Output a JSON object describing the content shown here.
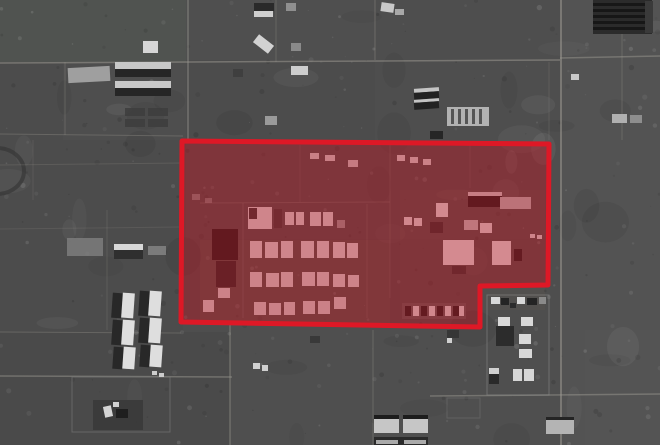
{
  "scene": {
    "description": "Grayscale satellite photograph of a desert compound with roads, warehouses, barracks rows and outlying villages; a large red polygon annotation highlights the central facility.",
    "width": 660,
    "height": 445,
    "ground_color": "#4e4e4e",
    "speckle_seed": 7,
    "patches": [
      [
        0,
        0,
        186,
        62,
        "#555a54",
        0.45
      ],
      [
        186,
        0,
        189,
        60,
        "#535353",
        0.4
      ],
      [
        560,
        0,
        100,
        445,
        "#5d5d5d",
        0.4
      ],
      [
        0,
        62,
        63,
        78,
        "#4a4a4a",
        0.3
      ],
      [
        186,
        60,
        189,
        83,
        "#4a4a4a",
        0.35
      ],
      [
        375,
        62,
        186,
        80,
        "#4f4f4f",
        0.3
      ],
      [
        0,
        140,
        183,
        192,
        "#4b4b4b",
        0.45
      ],
      [
        0,
        332,
        230,
        113,
        "#474747",
        0.4
      ],
      [
        230,
        330,
        330,
        115,
        "#525252",
        0.3
      ],
      [
        585,
        330,
        75,
        115,
        "#555555",
        0.3
      ],
      [
        186,
        143,
        363,
        96,
        "#565656",
        0.3
      ],
      [
        200,
        240,
        190,
        85,
        "#5e5a52",
        0.45
      ],
      [
        400,
        190,
        145,
        120,
        "#5a564f",
        0.4
      ]
    ],
    "roads": [
      [
        0,
        63,
        560,
        60,
        0.55,
        1.5
      ],
      [
        560,
        58,
        660,
        56,
        0.5,
        1.5
      ],
      [
        188,
        0,
        188,
        141,
        0.5,
        1.5
      ],
      [
        276,
        0,
        276,
        62,
        0.3,
        1
      ],
      [
        375,
        0,
        375,
        60,
        0.4,
        1
      ],
      [
        561,
        0,
        561,
        445,
        0.55,
        2
      ],
      [
        622,
        32,
        622,
        140,
        0.3,
        1
      ],
      [
        65,
        62,
        65,
        135,
        0.3,
        1
      ],
      [
        0,
        134,
        183,
        136,
        0.35,
        1
      ],
      [
        549,
        62,
        549,
        140,
        0.2,
        1
      ],
      [
        230,
        322,
        230,
        445,
        0.45,
        1.5
      ],
      [
        0,
        376,
        232,
        377,
        0.5,
        1.5
      ],
      [
        430,
        396,
        660,
        394,
        0.5,
        1.5
      ],
      [
        0,
        332,
        181,
        333,
        0.35,
        1
      ],
      [
        373,
        330,
        373,
        445,
        0.35,
        1
      ],
      [
        0,
        165,
        182,
        163,
        0.22,
        1
      ],
      [
        107,
        210,
        107,
        330,
        0.22,
        1
      ],
      [
        0,
        229,
        180,
        227,
        0.18,
        1
      ],
      [
        33,
        140,
        33,
        200,
        0.18,
        1
      ],
      [
        200,
        203,
        390,
        202,
        0.3,
        1
      ],
      [
        243,
        203,
        243,
        318,
        0.28,
        1
      ],
      [
        367,
        204,
        367,
        318,
        0.22,
        1
      ],
      [
        390,
        145,
        390,
        298,
        0.22,
        1
      ],
      [
        300,
        145,
        300,
        202,
        0.18,
        1
      ],
      [
        470,
        145,
        470,
        188,
        0.18,
        1
      ]
    ],
    "fences": [
      [
        72,
        377,
        98,
        55,
        "#7c7c7c",
        0.6
      ],
      [
        487,
        295,
        62,
        100,
        "#8a8a8a",
        0.55
      ],
      [
        447,
        398,
        33,
        20,
        "#7a7a7a",
        0.4
      ]
    ],
    "circle_feature": {
      "cx": -3,
      "cy": 171,
      "rx": 27,
      "ry": 23,
      "stroke": "#343434",
      "width": 4,
      "opacity": 0.6
    },
    "buildings": [
      [
        68,
        67,
        42,
        15,
        "#9f9f9f",
        1,
        -3
      ],
      [
        115,
        62,
        56,
        7,
        "#c8c8c8"
      ],
      [
        115,
        69,
        56,
        8,
        "#262626"
      ],
      [
        115,
        81,
        56,
        7,
        "#c8c8c8"
      ],
      [
        115,
        88,
        56,
        8,
        "#262626"
      ],
      [
        143,
        41,
        15,
        12,
        "#d6d6d6"
      ],
      [
        125,
        108,
        20,
        8,
        "#3c3c3c",
        0.8
      ],
      [
        148,
        108,
        20,
        8,
        "#3c3c3c",
        0.8
      ],
      [
        125,
        119,
        20,
        8,
        "#3c3c3c",
        0.8
      ],
      [
        148,
        119,
        20,
        8,
        "#3c3c3c",
        0.8
      ],
      [
        254,
        3,
        20,
        8,
        "#2a2a2a"
      ],
      [
        254,
        11,
        19,
        6,
        "#cfcfcf"
      ],
      [
        286,
        3,
        10,
        8,
        "#8f8f8f"
      ],
      [
        254,
        39,
        19,
        10,
        "#d2d2d2",
        1,
        38
      ],
      [
        291,
        43,
        10,
        8,
        "#8a8a8a"
      ],
      [
        291,
        66,
        17,
        9,
        "#cdcdcd"
      ],
      [
        233,
        69,
        10,
        8,
        "#3a3a3a",
        0.7
      ],
      [
        265,
        116,
        12,
        9,
        "#9a9a9a"
      ],
      [
        381,
        3,
        13,
        9,
        "#c8c8c8",
        1,
        8
      ],
      [
        395,
        9,
        9,
        6,
        "#a8a8a8"
      ],
      [
        414,
        88,
        25,
        4,
        "#c4c4c4",
        1,
        -4
      ],
      [
        414,
        92,
        25,
        7,
        "#222222",
        1,
        -4
      ],
      [
        414,
        99,
        25,
        3,
        "#c4c4c4",
        1,
        -4
      ],
      [
        414,
        102,
        25,
        7,
        "#222222",
        1,
        -4
      ],
      [
        447,
        107,
        42,
        19,
        "#b2b2b2"
      ],
      [
        451,
        109,
        3,
        15,
        "#555555"
      ],
      [
        458,
        109,
        3,
        15,
        "#555555"
      ],
      [
        465,
        109,
        3,
        15,
        "#555555"
      ],
      [
        472,
        109,
        3,
        15,
        "#555555"
      ],
      [
        479,
        109,
        3,
        15,
        "#555555"
      ],
      [
        430,
        131,
        13,
        8,
        "#262626"
      ],
      [
        571,
        74,
        8,
        6,
        "#c8c8c8"
      ],
      [
        612,
        114,
        15,
        9,
        "#b0b0b0"
      ],
      [
        630,
        115,
        12,
        8,
        "#8e8e8e"
      ],
      [
        593,
        0,
        59,
        34,
        "#2b2b2b"
      ],
      [
        593,
        3,
        59,
        3,
        "#171717"
      ],
      [
        593,
        9,
        59,
        3,
        "#171717"
      ],
      [
        593,
        15,
        59,
        3,
        "#171717"
      ],
      [
        593,
        21,
        59,
        3,
        "#171717"
      ],
      [
        593,
        27,
        59,
        3,
        "#171717"
      ],
      [
        645,
        1,
        8,
        32,
        "#3a3a3a"
      ],
      [
        67,
        238,
        36,
        18,
        "#7c7c7c",
        0.85
      ],
      [
        114,
        244,
        29,
        6,
        "#d8d8d8"
      ],
      [
        114,
        250,
        29,
        9,
        "#2f2f2f"
      ],
      [
        148,
        246,
        18,
        9,
        "#909090",
        0.7
      ],
      [
        112,
        293,
        10,
        25,
        "#282828",
        1,
        4
      ],
      [
        122,
        293,
        12,
        25,
        "#dedede",
        1,
        4
      ],
      [
        139,
        291,
        10,
        25,
        "#282828",
        1,
        4
      ],
      [
        149,
        291,
        12,
        25,
        "#dedede",
        1,
        4
      ],
      [
        112,
        320,
        10,
        25,
        "#282828",
        1,
        4
      ],
      [
        122,
        320,
        12,
        25,
        "#dedede",
        1,
        4
      ],
      [
        139,
        318,
        10,
        25,
        "#282828",
        1,
        4
      ],
      [
        149,
        318,
        12,
        25,
        "#dedede",
        1,
        4
      ],
      [
        113,
        347,
        10,
        22,
        "#282828",
        1,
        4
      ],
      [
        123,
        347,
        12,
        22,
        "#dedede",
        1,
        4
      ],
      [
        140,
        345,
        10,
        22,
        "#282828",
        1,
        4
      ],
      [
        150,
        345,
        12,
        22,
        "#dedede",
        1,
        4
      ],
      [
        93,
        400,
        50,
        30,
        "#3a3a3a",
        0.9
      ],
      [
        104,
        406,
        8,
        11,
        "#d4d4d4",
        1,
        -12
      ],
      [
        116,
        409,
        12,
        9,
        "#1f1f1f"
      ],
      [
        113,
        402,
        6,
        5,
        "#d0d0d0"
      ],
      [
        152,
        371,
        5,
        4,
        "#cccccc"
      ],
      [
        159,
        373,
        5,
        4,
        "#cccccc"
      ],
      [
        253,
        363,
        7,
        6,
        "#d2d2d2"
      ],
      [
        262,
        365,
        6,
        6,
        "#cfcfcf"
      ],
      [
        447,
        338,
        5,
        5,
        "#d0d0d0"
      ],
      [
        310,
        336,
        10,
        7,
        "#303030",
        0.7
      ],
      [
        447,
        330,
        12,
        8,
        "#2e2e2e",
        0.7
      ],
      [
        491,
        297,
        9,
        7,
        "#d8d8d8"
      ],
      [
        501,
        298,
        8,
        7,
        "#242424"
      ],
      [
        517,
        297,
        8,
        7,
        "#d8d8d8"
      ],
      [
        527,
        298,
        10,
        7,
        "#242424"
      ],
      [
        539,
        297,
        7,
        7,
        "#8a8a8a"
      ],
      [
        498,
        317,
        12,
        9,
        "#d8d8d8"
      ],
      [
        521,
        317,
        12,
        9,
        "#d8d8d8"
      ],
      [
        496,
        326,
        18,
        20,
        "#262626",
        0.85
      ],
      [
        519,
        334,
        12,
        10,
        "#d8d8d8"
      ],
      [
        519,
        349,
        13,
        9,
        "#d8d8d8"
      ],
      [
        489,
        368,
        10,
        6,
        "#d0d0d0"
      ],
      [
        489,
        374,
        10,
        10,
        "#2a2a2a"
      ],
      [
        513,
        369,
        9,
        12,
        "#d6d6d6"
      ],
      [
        524,
        369,
        10,
        12,
        "#d6d6d6"
      ],
      [
        510,
        303,
        6,
        5,
        "#2c2c2c"
      ],
      [
        374,
        415,
        25,
        4,
        "#1d1d1d"
      ],
      [
        374,
        419,
        25,
        14,
        "#c6c6c6"
      ],
      [
        403,
        415,
        25,
        4,
        "#1d1d1d"
      ],
      [
        403,
        419,
        25,
        14,
        "#c6c6c6"
      ],
      [
        374,
        437,
        54,
        8,
        "#202020",
        0.8
      ],
      [
        376,
        440,
        22,
        4,
        "#aaaaaa"
      ],
      [
        404,
        440,
        22,
        4,
        "#aaaaaa"
      ],
      [
        546,
        417,
        28,
        4,
        "#242424"
      ],
      [
        546,
        420,
        28,
        14,
        "#b4b4b4"
      ],
      [
        212,
        229,
        26,
        31,
        "#1f1f1f"
      ],
      [
        216,
        261,
        20,
        26,
        "#2b2b2b"
      ],
      [
        248,
        207,
        24,
        22,
        "#d9d9d9"
      ],
      [
        249,
        208,
        8,
        11,
        "#3a3a3a"
      ],
      [
        274,
        209,
        8,
        19,
        "#3f3f3f"
      ],
      [
        285,
        212,
        9,
        13,
        "#d7d7d7"
      ],
      [
        296,
        212,
        8,
        13,
        "#d7d7d7"
      ],
      [
        310,
        212,
        11,
        14,
        "#d7d7d7"
      ],
      [
        323,
        212,
        10,
        14,
        "#d7d7d7"
      ],
      [
        337,
        220,
        8,
        8,
        "#9a9a9a"
      ],
      [
        250,
        241,
        12,
        17,
        "#dadada"
      ],
      [
        265,
        242,
        13,
        16,
        "#dadada"
      ],
      [
        281,
        241,
        12,
        17,
        "#dadada"
      ],
      [
        301,
        241,
        13,
        17,
        "#dadada"
      ],
      [
        317,
        241,
        12,
        17,
        "#dadada"
      ],
      [
        333,
        242,
        12,
        16,
        "#dadada"
      ],
      [
        347,
        243,
        11,
        15,
        "#dadada"
      ],
      [
        250,
        272,
        12,
        15,
        "#d6d6d6"
      ],
      [
        266,
        273,
        13,
        14,
        "#d6d6d6"
      ],
      [
        281,
        272,
        12,
        15,
        "#d6d6d6"
      ],
      [
        302,
        272,
        13,
        14,
        "#d6d6d6"
      ],
      [
        317,
        272,
        12,
        14,
        "#d6d6d6"
      ],
      [
        333,
        274,
        12,
        13,
        "#d6d6d6"
      ],
      [
        348,
        275,
        11,
        12,
        "#d6d6d6"
      ],
      [
        254,
        302,
        12,
        13,
        "#d2d2d2"
      ],
      [
        269,
        303,
        12,
        12,
        "#d2d2d2"
      ],
      [
        284,
        302,
        11,
        13,
        "#d2d2d2"
      ],
      [
        303,
        301,
        12,
        13,
        "#d2d2d2"
      ],
      [
        318,
        301,
        12,
        13,
        "#d2d2d2"
      ],
      [
        334,
        297,
        12,
        12,
        "#d2d2d2"
      ],
      [
        218,
        288,
        12,
        10,
        "#d4d4d4"
      ],
      [
        203,
        300,
        11,
        12,
        "#d4d4d4"
      ],
      [
        310,
        153,
        9,
        6,
        "#cfcfcf"
      ],
      [
        325,
        155,
        10,
        6,
        "#cfcfcf"
      ],
      [
        348,
        160,
        10,
        7,
        "#c8c8c8"
      ],
      [
        397,
        155,
        8,
        6,
        "#d2d2d2"
      ],
      [
        410,
        157,
        8,
        6,
        "#d2d2d2"
      ],
      [
        423,
        159,
        8,
        6,
        "#d2d2d2"
      ],
      [
        192,
        194,
        8,
        6,
        "#999999",
        0.7
      ],
      [
        205,
        198,
        7,
        5,
        "#999999",
        0.6
      ],
      [
        468,
        192,
        34,
        4,
        "#cccccc"
      ],
      [
        468,
        196,
        34,
        11,
        "#1f1f1f"
      ],
      [
        500,
        197,
        31,
        12,
        "#b8b8b8"
      ],
      [
        436,
        203,
        12,
        14,
        "#e0e0e0"
      ],
      [
        404,
        217,
        8,
        8,
        "#dcdcdc"
      ],
      [
        414,
        218,
        8,
        8,
        "#dcdcdc"
      ],
      [
        464,
        220,
        14,
        10,
        "#c0c0c0"
      ],
      [
        480,
        223,
        12,
        10,
        "#dcdcdc"
      ],
      [
        430,
        222,
        13,
        11,
        "#343434"
      ],
      [
        443,
        240,
        31,
        25,
        "#e2e2e2"
      ],
      [
        492,
        241,
        19,
        24,
        "#e2e2e2"
      ],
      [
        514,
        249,
        8,
        12,
        "#242424"
      ],
      [
        530,
        234,
        5,
        4,
        "#d8d8d8"
      ],
      [
        537,
        235,
        5,
        4,
        "#d8d8d8"
      ],
      [
        452,
        266,
        14,
        8,
        "#2e2e2e",
        0.7
      ],
      [
        402,
        303,
        64,
        16,
        "#6e6e6e",
        0.45
      ],
      [
        405,
        306,
        6,
        10,
        "#222222"
      ],
      [
        413,
        306,
        6,
        10,
        "#dcdcdc"
      ],
      [
        421,
        306,
        6,
        10,
        "#222222"
      ],
      [
        429,
        306,
        6,
        10,
        "#dcdcdc"
      ],
      [
        437,
        306,
        6,
        10,
        "#222222"
      ],
      [
        445,
        306,
        6,
        10,
        "#dcdcdc"
      ],
      [
        453,
        306,
        6,
        10,
        "#222222"
      ],
      [
        459,
        306,
        5,
        10,
        "#dcdcdc"
      ]
    ]
  },
  "annotation": {
    "name": "highlighted-area",
    "shape": "polygon",
    "points": [
      [
        182,
        141
      ],
      [
        549,
        144
      ],
      [
        548,
        285
      ],
      [
        480,
        286
      ],
      [
        480,
        327
      ],
      [
        181,
        322
      ]
    ],
    "stroke_color": "#de1826",
    "stroke_width": 5,
    "fill_color": "#c01020",
    "fill_opacity": 0.42
  }
}
